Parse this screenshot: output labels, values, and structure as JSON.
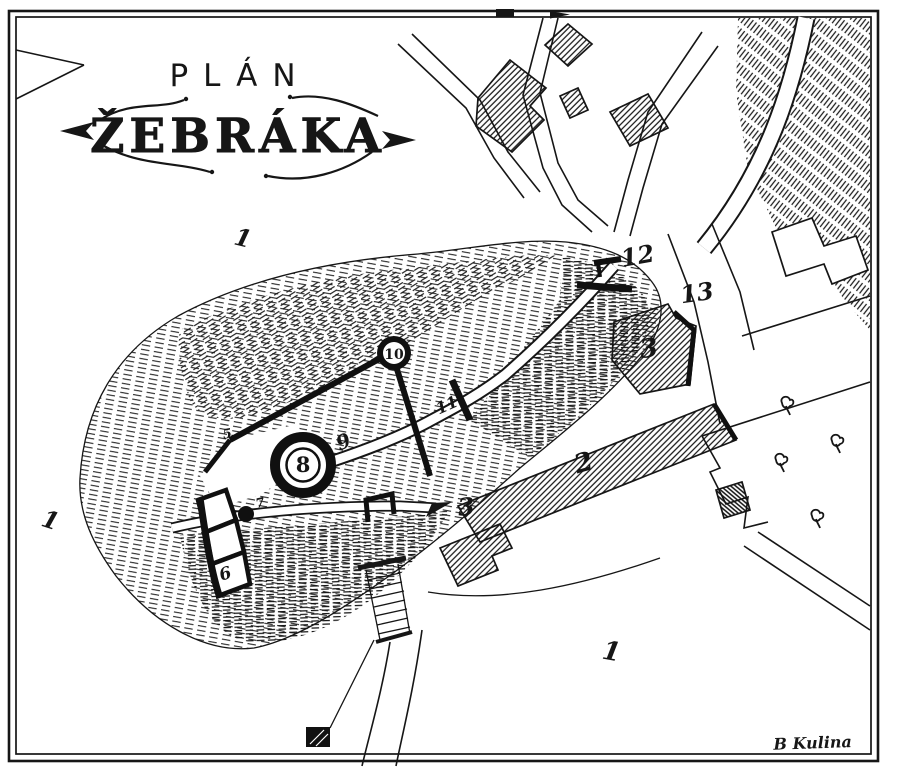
{
  "map": {
    "title": {
      "line1": "PLÁN",
      "line2": "ŽEBRÁKA"
    },
    "signature": "B Kulina",
    "colors": {
      "ink": "#161616",
      "paper": "#ffffff"
    },
    "labels": [
      {
        "id": "field-1-northwest",
        "text": "1",
        "x": 241,
        "y": 246,
        "size": 24,
        "rotate": 14
      },
      {
        "id": "field-1-west",
        "text": "1",
        "x": 48,
        "y": 528,
        "size": 24,
        "rotate": 18
      },
      {
        "id": "field-1-south",
        "text": "1",
        "x": 610,
        "y": 660,
        "size": 26,
        "rotate": 10
      },
      {
        "id": "building-2",
        "text": "2",
        "x": 586,
        "y": 471,
        "size": 26,
        "rotate": -16
      },
      {
        "id": "building-3",
        "text": "3",
        "x": 650,
        "y": 357,
        "size": 26,
        "rotate": -8
      },
      {
        "id": "path-3",
        "text": "3",
        "x": 467,
        "y": 515,
        "size": 24,
        "rotate": -6
      },
      {
        "id": "mark-5",
        "text": "5",
        "x": 228,
        "y": 438,
        "size": 13,
        "rotate": -10
      },
      {
        "id": "building-6",
        "text": "6",
        "x": 227,
        "y": 579,
        "size": 17,
        "rotate": -18
      },
      {
        "id": "mark-7",
        "text": "7",
        "x": 261,
        "y": 507,
        "size": 13,
        "rotate": -12
      },
      {
        "id": "tower-8",
        "text": "8",
        "x": 303,
        "y": 472,
        "size": 21,
        "rotate": 0,
        "up": true
      },
      {
        "id": "path-9",
        "text": "9",
        "x": 346,
        "y": 448,
        "size": 20,
        "rotate": -22
      },
      {
        "id": "tower-10",
        "text": "10",
        "x": 394,
        "y": 359,
        "size": 14,
        "rotate": 0,
        "up": true
      },
      {
        "id": "gate-11",
        "text": "11",
        "x": 449,
        "y": 410,
        "size": 16,
        "rotate": -24
      },
      {
        "id": "gate-12",
        "text": "12",
        "x": 639,
        "y": 264,
        "size": 24,
        "rotate": -10
      },
      {
        "id": "road-13",
        "text": "13",
        "x": 698,
        "y": 301,
        "size": 24,
        "rotate": -8
      }
    ],
    "trees": [
      {
        "x": 786,
        "y": 406
      },
      {
        "x": 836,
        "y": 444
      },
      {
        "x": 780,
        "y": 463
      },
      {
        "x": 816,
        "y": 519
      }
    ]
  }
}
